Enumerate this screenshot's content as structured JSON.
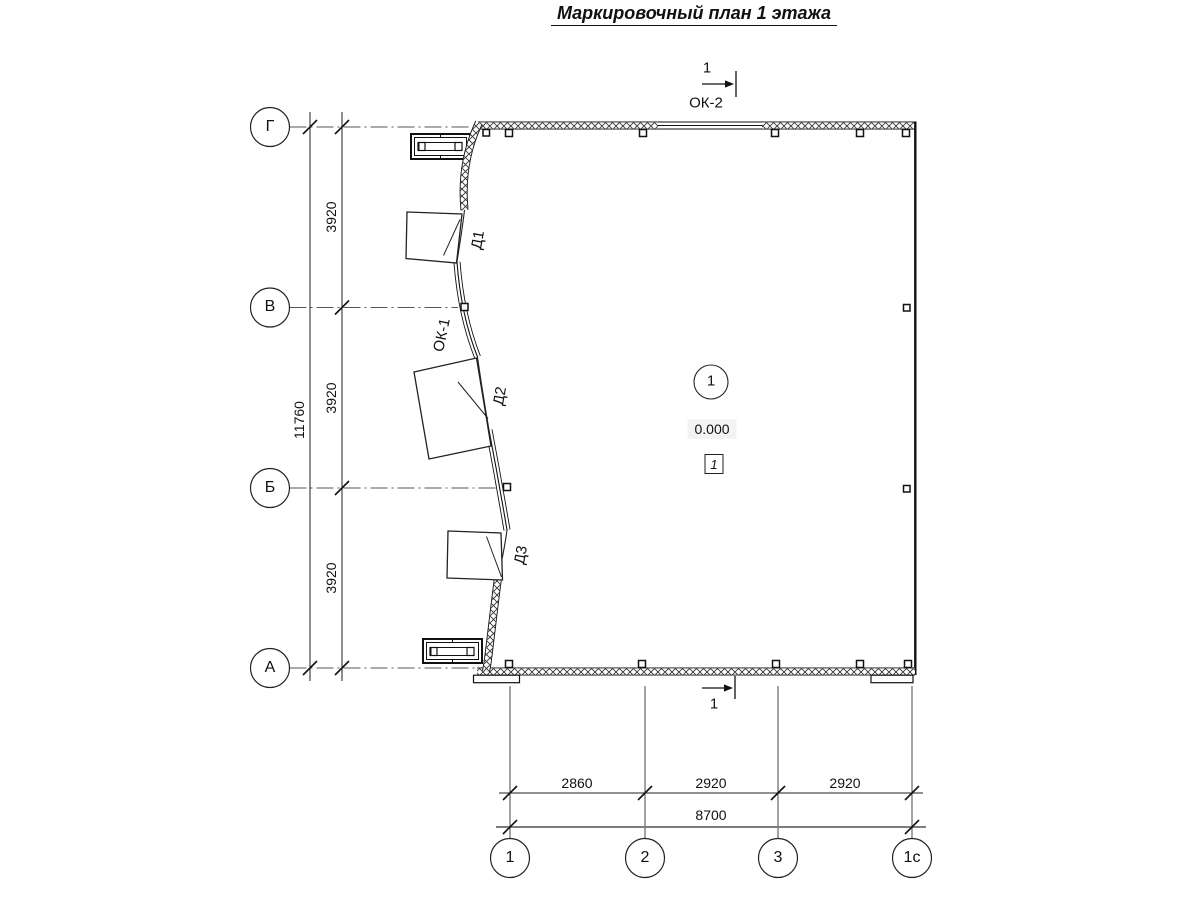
{
  "title": "Маркировочный план 1 этажа",
  "axes": {
    "rows": [
      {
        "label": "Г"
      },
      {
        "label": "В"
      },
      {
        "label": "Б"
      },
      {
        "label": "А"
      }
    ],
    "cols": [
      {
        "label": "1"
      },
      {
        "label": "2"
      },
      {
        "label": "3"
      },
      {
        "label": "1с"
      }
    ]
  },
  "dimensions": {
    "left_segments": [
      "3920",
      "3920",
      "3920"
    ],
    "left_total": "11760",
    "bottom_segments": [
      "2860",
      "2920",
      "2920"
    ],
    "bottom_total": "8700"
  },
  "section_mark": {
    "number": "1"
  },
  "windows": {
    "ok1": "ОК-1",
    "ok2": "ОК-2"
  },
  "doors": {
    "d1": "Д1",
    "d2": "Д2",
    "d3": "Д3"
  },
  "room": {
    "number": "1",
    "elevation": "0.000",
    "finish_type": "1"
  }
}
